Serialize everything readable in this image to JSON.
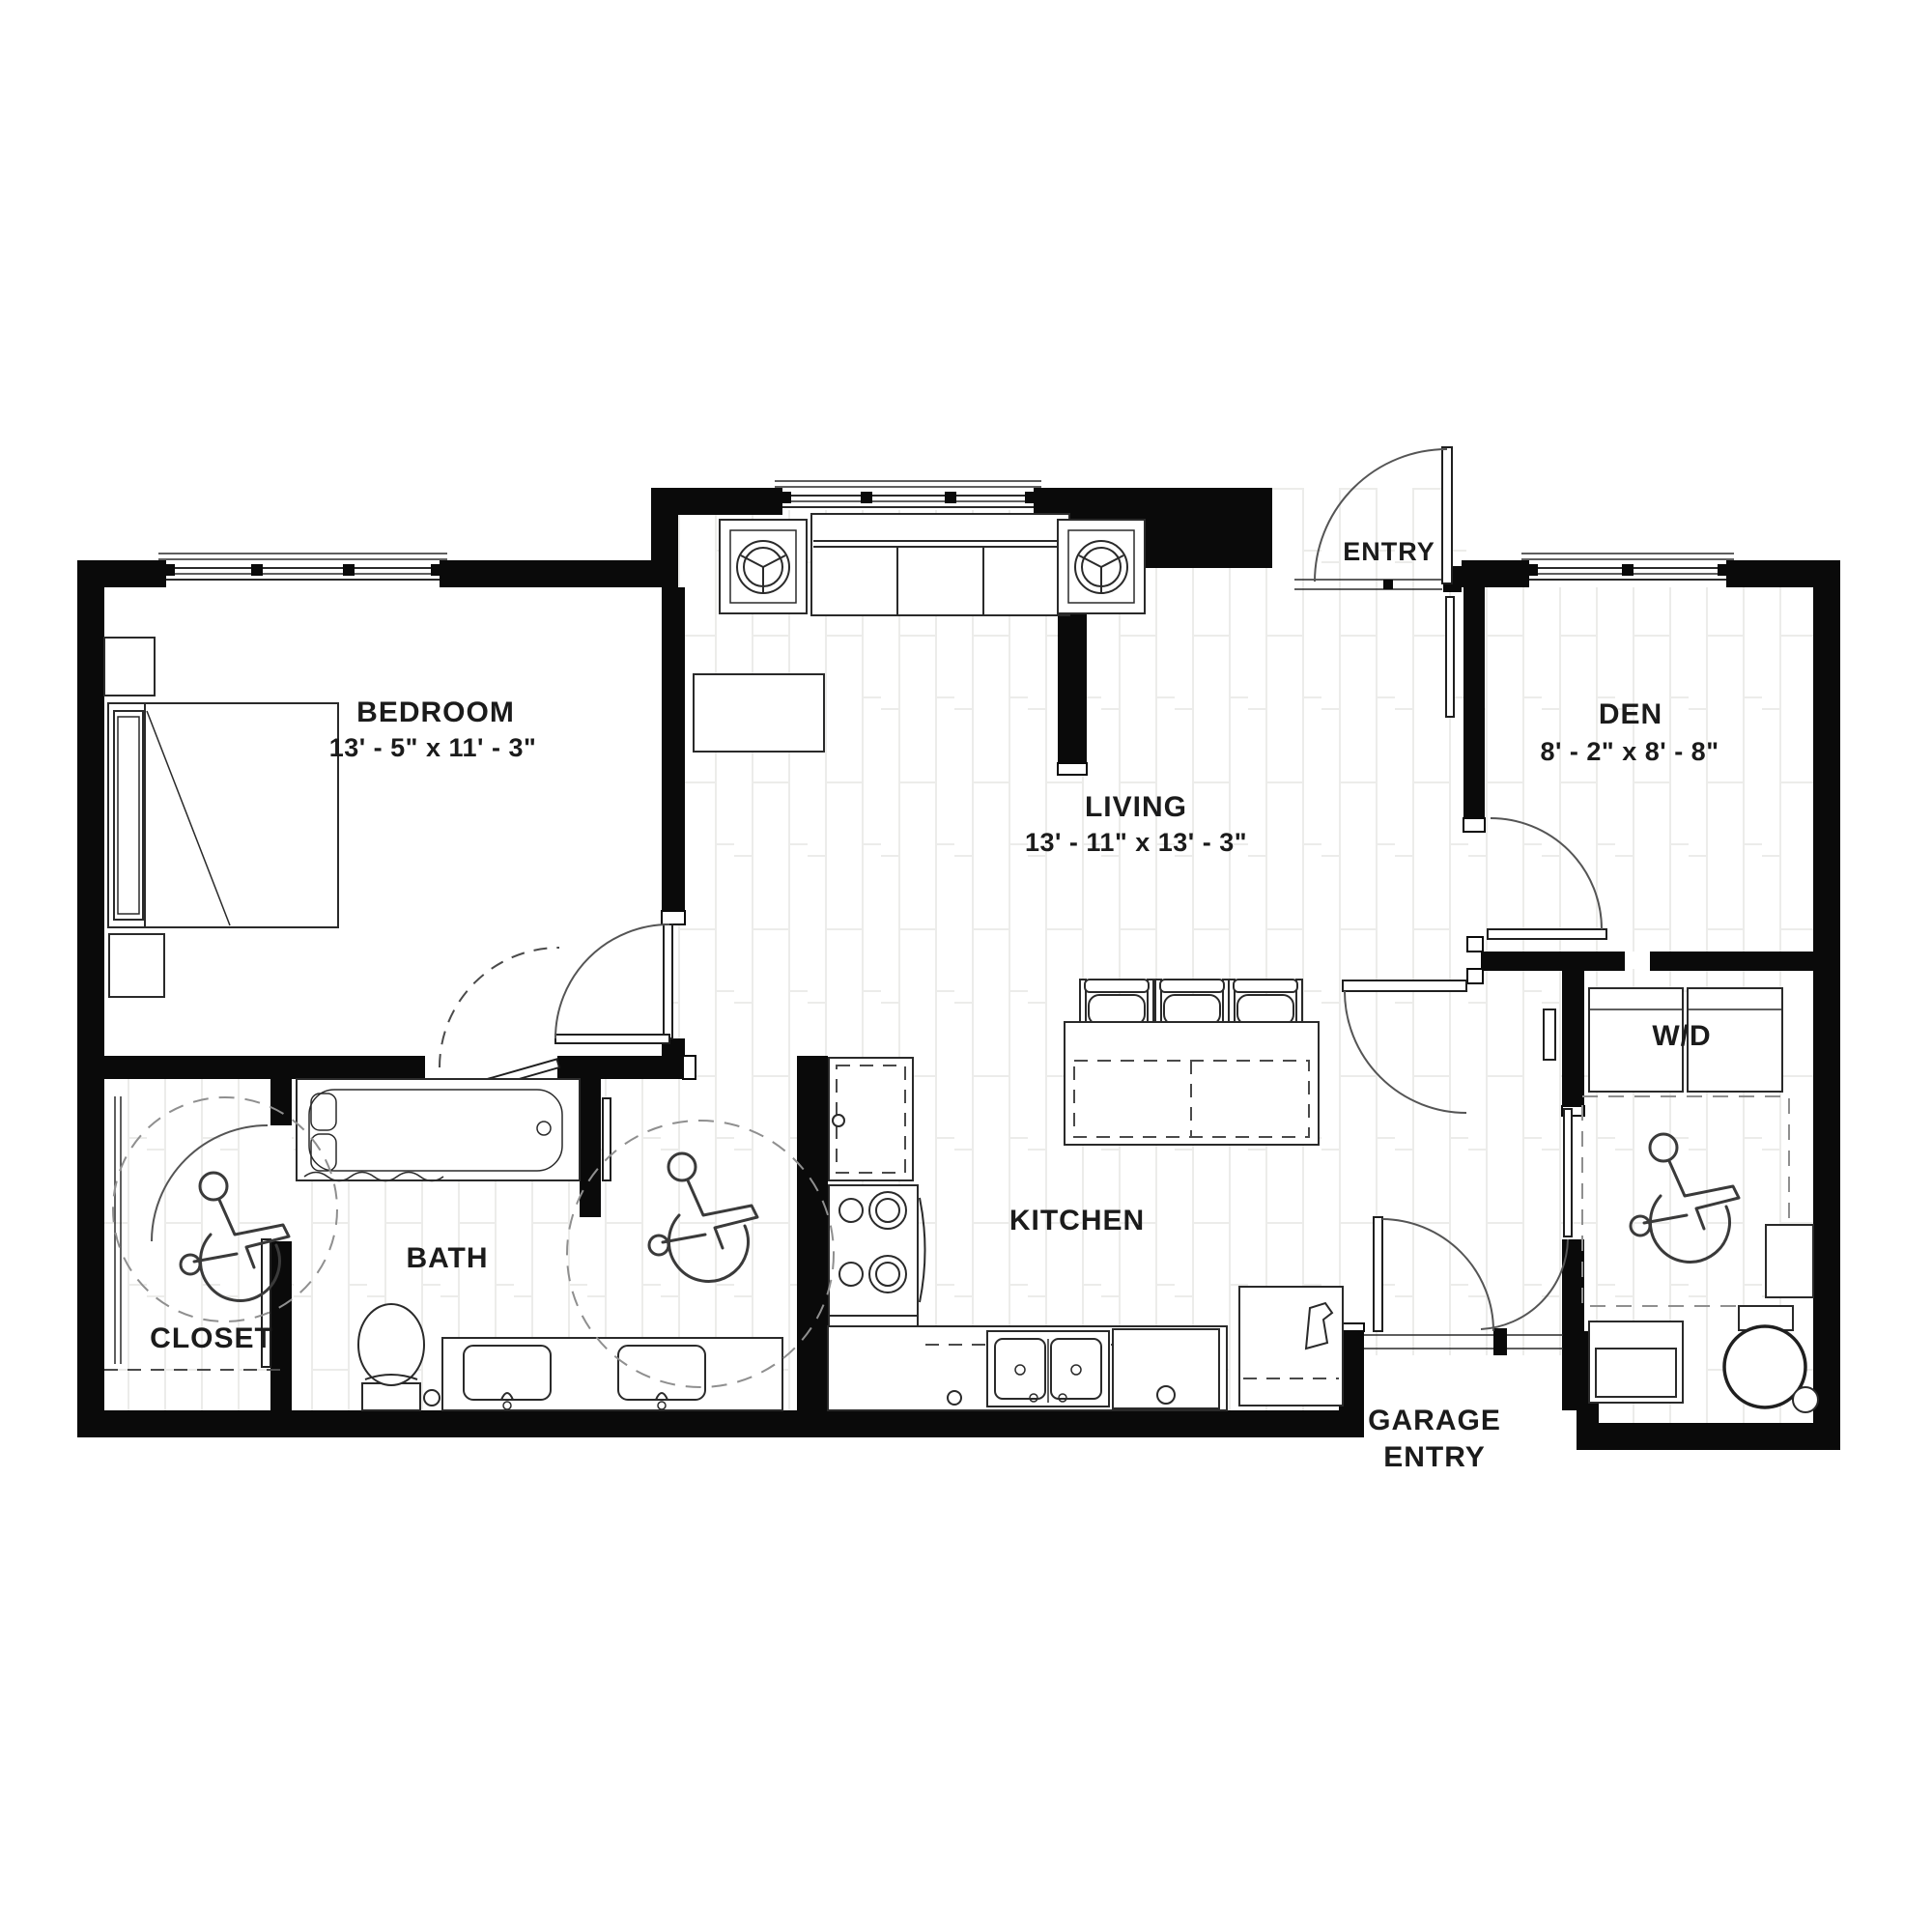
{
  "title": "Apartment unit floor plan",
  "colors": {
    "background": "#ffffff",
    "walls": "#0a0a0a",
    "fixture_line": "#2a2a2a",
    "dashed_line": "#8f8f8f",
    "label_text": "#1b1b1b"
  },
  "rooms": {
    "bedroom": {
      "label": "BEDROOM",
      "dims": "13' - 5\" x 11' - 3\""
    },
    "living": {
      "label": "LIVING",
      "dims": "13' - 11\" x 13' - 3\""
    },
    "den": {
      "label": "DEN",
      "dims": "8' - 2\" x 8' - 8\""
    },
    "entry": {
      "label": "ENTRY"
    },
    "kitchen": {
      "label": "KITCHEN"
    },
    "bath": {
      "label": "BATH"
    },
    "closet": {
      "label": "CLOSET"
    },
    "laundry": {
      "label": "W/D"
    },
    "garage_entry": {
      "label_line1": "GARAGE",
      "label_line2": "ENTRY"
    }
  },
  "icons": {
    "accessibility": "wheelchair-icon",
    "accessibility_locations": [
      "closet",
      "bath",
      "laundry-room"
    ]
  }
}
